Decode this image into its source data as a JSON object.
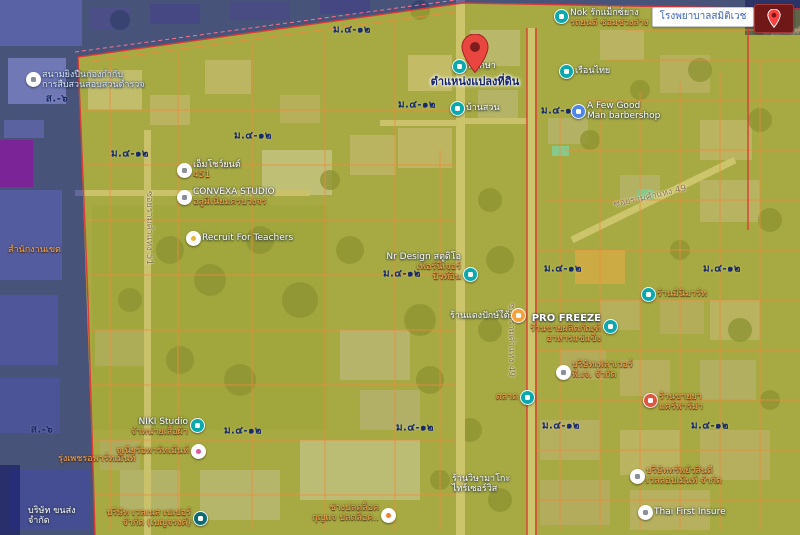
{
  "search": {
    "query": "โรงพยาบาลสมิติเวช"
  },
  "map": {
    "pin_label": "ตำแหน่งแปลงที่ดิน",
    "zone_labels": [
      {
        "text": "ส.-๖",
        "x": 57,
        "y": 99
      },
      {
        "text": "ส.-๖",
        "x": 42,
        "y": 430
      },
      {
        "text": "ม.๔-๑๒",
        "x": 352,
        "y": 30
      },
      {
        "text": "ม.๔-๑๒",
        "x": 130,
        "y": 154
      },
      {
        "text": "ม.๔-๑๒",
        "x": 253,
        "y": 136
      },
      {
        "text": "ม.๔-๑๒",
        "x": 417,
        "y": 105
      },
      {
        "text": "ม.๔-๑๒",
        "x": 560,
        "y": 111
      },
      {
        "text": "ม.๔-๑๒",
        "x": 402,
        "y": 274
      },
      {
        "text": "ม.๔-๑๒",
        "x": 563,
        "y": 269
      },
      {
        "text": "ม.๔-๑๒",
        "x": 722,
        "y": 269
      },
      {
        "text": "ม.๔-๑๒",
        "x": 243,
        "y": 431
      },
      {
        "text": "ม.๔-๑๒",
        "x": 415,
        "y": 428
      },
      {
        "text": "ม.๔-๑๒",
        "x": 561,
        "y": 426
      },
      {
        "text": "ม.๔-๑๒",
        "x": 710,
        "y": 426
      }
    ],
    "road_labels": [
      {
        "text": "ซอยรามคำแหง 49",
        "x": 650,
        "y": 196,
        "rot": -13
      },
      {
        "text": "ซอยรามคำแหง 49",
        "x": 512,
        "y": 340,
        "rot": 90
      },
      {
        "text": "ซอยรามคำแหง 51",
        "x": 150,
        "y": 228,
        "rot": 90
      },
      {
        "text": "กรุงเทพกรีฑา",
        "x": 790,
        "y": 31,
        "rot": 0
      }
    ],
    "pois": [
      {
        "name": "shooting-range",
        "icon": "target",
        "color": "white",
        "x": 33,
        "y": 79,
        "side": "right",
        "dy": -9,
        "lines": [
          {
            "t": "สนามยิงปืนกองกำกับ",
            "tone": "light"
          },
          {
            "t": "การสืบสวนสอบสวนตำรวจ",
            "tone": "light"
          }
        ]
      },
      {
        "name": "nok-tire-shop",
        "icon": "shopping",
        "color": "teal",
        "x": 561,
        "y": 16,
        "side": "right",
        "dy": -8,
        "lines": [
          {
            "t": "Nok รักแม็กซ์ยาง",
            "tone": "primary"
          },
          {
            "t": "รถยนต์ ซ่อมช่วงล่าง",
            "tone": "secondary"
          }
        ]
      },
      {
        "name": "ruen-thai",
        "icon": "store",
        "color": "teal",
        "x": 566,
        "y": 71,
        "side": "right",
        "dy": -5,
        "lines": [
          {
            "t": "เรือนไทย",
            "tone": "primary"
          }
        ]
      },
      {
        "name": "barbershop",
        "icon": "scissors",
        "color": "blue",
        "x": 578,
        "y": 111,
        "side": "right",
        "dy": -10,
        "lines": [
          {
            "t": "A Few Good",
            "tone": "primary"
          },
          {
            "t": "Man barbershop",
            "tone": "primary"
          }
        ]
      },
      {
        "name": "phruksa",
        "icon": "shopping",
        "color": "teal",
        "x": 459,
        "y": 66,
        "side": "right",
        "dy": -5,
        "lines": [
          {
            "t": "พฤกษา",
            "tone": "primary"
          }
        ]
      },
      {
        "name": "baan-suan",
        "icon": "cart",
        "color": "teal",
        "x": 457,
        "y": 108,
        "side": "right",
        "dy": -5,
        "lines": [
          {
            "t": "บ้านสวน",
            "tone": "primary"
          }
        ]
      },
      {
        "name": "show-yon",
        "icon": "store",
        "color": "white",
        "x": 184,
        "y": 170,
        "side": "right",
        "dy": -10,
        "lines": [
          {
            "t": "เอ็มโชว์ยนต์",
            "tone": "primary"
          },
          {
            "t": "451",
            "tone": "secondary"
          }
        ]
      },
      {
        "name": "convexa-studio",
        "icon": "store",
        "color": "white",
        "x": 184,
        "y": 197,
        "side": "right",
        "dy": -10,
        "lines": [
          {
            "t": "CONVEXA STUDIO",
            "tone": "primary"
          },
          {
            "t": "อลูมิเนียมครบวงจร",
            "tone": "secondary"
          }
        ]
      },
      {
        "name": "recruit-for-teachers",
        "icon": "briefcase",
        "color": "yellow",
        "x": 193,
        "y": 238,
        "side": "right",
        "dy": -5,
        "lines": [
          {
            "t": "Recruit For Teachers",
            "tone": "primary"
          }
        ]
      },
      {
        "name": "nr-design",
        "icon": "store",
        "color": "teal",
        "x": 470,
        "y": 274,
        "side": "left",
        "dy": -22,
        "lines": [
          {
            "t": "Nr Design สตูดิโอ",
            "tone": "primary"
          },
          {
            "t": "เฟอร์นิเจอร์",
            "tone": "secondary"
          },
          {
            "t": "บิวท์อิน",
            "tone": "secondary"
          }
        ]
      },
      {
        "name": "dang-paktai",
        "icon": "none",
        "color": "teal",
        "x": 450,
        "y": 311,
        "side": "none",
        "dy": 0,
        "lines": [
          {
            "t": "ร้านแดงปักษ์ใต้",
            "tone": "primary"
          }
        ]
      },
      {
        "name": "pro-freeze",
        "icon": "lock",
        "color": "teal",
        "x": 610,
        "y": 326,
        "side": "left",
        "dy": -12,
        "lines": [
          {
            "t": "PRO FREEZE",
            "tone": "bold"
          },
          {
            "t": "ร้านขายผลิตภัณฑ์",
            "tone": "secondary"
          },
          {
            "t": "อาหารแช่แข็ง",
            "tone": "secondary"
          }
        ]
      },
      {
        "name": "minimart",
        "icon": "lock",
        "color": "teal",
        "x": 648,
        "y": 294,
        "side": "right",
        "dy": -5,
        "lines": [
          {
            "t": "ร้านมินิมาร์ท",
            "tone": "secondary"
          }
        ]
      },
      {
        "name": "flower-company",
        "icon": "building",
        "color": "white",
        "x": 563,
        "y": 372,
        "side": "right",
        "dy": -12,
        "lines": [
          {
            "t": "บริษัทเฟลาเวอร์",
            "tone": "secondary"
          },
          {
            "t": "พี.เจ. จำกัด",
            "tone": "secondary"
          }
        ]
      },
      {
        "name": "pharmacy",
        "icon": "pharmacy",
        "color": "red",
        "x": 650,
        "y": 400,
        "side": "right",
        "dy": -8,
        "lines": [
          {
            "t": "ร้านขายยา",
            "tone": "secondary"
          },
          {
            "t": "แคร์ฟาร์ม่า",
            "tone": "secondary"
          }
        ]
      },
      {
        "name": "niki-studio",
        "icon": "shopping",
        "color": "teal",
        "x": 197,
        "y": 425,
        "side": "left",
        "dy": -8,
        "lines": [
          {
            "t": "NIKI Studio",
            "tone": "primary"
          },
          {
            "t": "จำหน่ายเสื้อผ้า",
            "tone": "secondary"
          }
        ]
      },
      {
        "name": "junior-apartment",
        "icon": "lodging",
        "color": "pink",
        "x": 198,
        "y": 451,
        "side": "left",
        "dy": -5,
        "lines": [
          {
            "t": "จูเนียร์อพาร์ทเม้นท์",
            "tone": "secondary"
          }
        ]
      },
      {
        "name": "wellness-paper",
        "icon": "building",
        "color": "dark",
        "x": 200,
        "y": 518,
        "side": "left",
        "dy": -10,
        "lines": [
          {
            "t": "บริษัท เวลเนส เปเปอร์",
            "tone": "secondary"
          },
          {
            "t": "จำกัด (เบญจรงค์)",
            "tone": "secondary"
          }
        ]
      },
      {
        "name": "locksmith",
        "icon": "key",
        "color": "white-orange",
        "x": 388,
        "y": 515,
        "side": "left",
        "dy": -12,
        "lines": [
          {
            "t": "ช่างปลดล็อค",
            "tone": "secondary"
          },
          {
            "t": "กุญแจ ปลดล็อค..",
            "tone": "secondary"
          }
        ]
      },
      {
        "name": "sub-wasin-development",
        "icon": "building",
        "color": "white",
        "x": 637,
        "y": 476,
        "side": "right",
        "dy": -10,
        "lines": [
          {
            "t": "บริษัททรัพย์วสินดี",
            "tone": "secondary"
          },
          {
            "t": "เวลลอปเม้นท์ จำกัด",
            "tone": "secondary"
          }
        ]
      },
      {
        "name": "thai-first-insure",
        "icon": "building",
        "color": "white",
        "x": 645,
        "y": 512,
        "side": "right",
        "dy": -5,
        "lines": [
          {
            "t": "Thai First Insure",
            "tone": "primary"
          }
        ]
      },
      {
        "name": "district-office",
        "icon": "none",
        "color": "teal",
        "x": 8,
        "y": 245,
        "side": "none",
        "dy": 0,
        "lines": [
          {
            "t": "สำนักงานเขต",
            "tone": "secondary"
          }
        ]
      },
      {
        "name": "wisa-tire-service",
        "icon": "none",
        "color": "teal",
        "x": 452,
        "y": 474,
        "side": "none",
        "dy": 0,
        "lines": [
          {
            "t": "ร้านวิษามาโกะ",
            "tone": "primary"
          },
          {
            "t": "ไทร์เซอร์วิส",
            "tone": "primary"
          }
        ]
      },
      {
        "name": "rungphet-apartment",
        "icon": "none",
        "color": "teal",
        "x": 58,
        "y": 454,
        "side": "none",
        "dy": 0,
        "lines": [
          {
            "t": "รุ่งเพชรอพาร์ทเม้นท์",
            "tone": "secondary"
          }
        ]
      },
      {
        "name": "transport-company",
        "icon": "none",
        "color": "teal",
        "x": 28,
        "y": 506,
        "side": "none",
        "dy": 0,
        "lines": [
          {
            "t": "บริษัท ขนส่ง",
            "tone": "primary"
          },
          {
            "t": "จำกัด",
            "tone": "primary"
          }
        ]
      },
      {
        "name": "orange-place",
        "icon": "place",
        "color": "orange",
        "x": 518,
        "y": 315,
        "side": "none",
        "dy": 0,
        "lines": []
      },
      {
        "name": "talad-market",
        "icon": "shopping",
        "color": "teal",
        "x": 527,
        "y": 397,
        "side": "left",
        "dy": -5,
        "lines": [
          {
            "t": "ตลาด",
            "tone": "secondary"
          }
        ]
      }
    ]
  },
  "colors": {
    "marker_teal": "#0ba9ad",
    "marker_blue": "#4e86ec",
    "marker_red": "#e05540",
    "marker_pink": "#e0559b",
    "marker_yellow": "#e8b73a",
    "marker_orange": "#f6a13b",
    "marker_dark": "#0c6b70",
    "pin_red": "#e9463f",
    "secondary_text": "#f3aa54",
    "zone_code_text": "#16286b",
    "residential_overlay": "#ebe437",
    "government_overlay": "#1e2aa5",
    "parcel_line": "#f08a3c",
    "boundary_line": "#e03535",
    "search_text": "#3b5fc0"
  }
}
